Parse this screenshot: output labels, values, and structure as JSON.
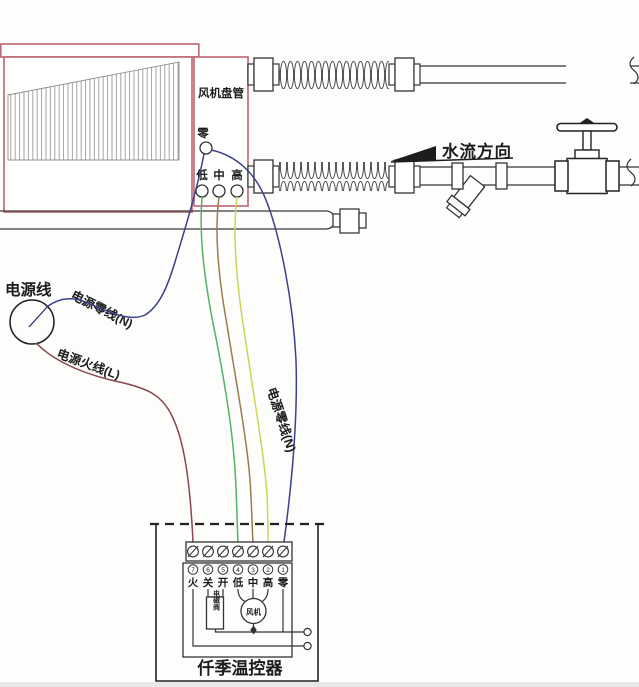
{
  "fan_coil": {
    "label": "风机盘管",
    "neutral": "零",
    "speeds": [
      "低",
      "中",
      "高"
    ]
  },
  "flow": {
    "label": "水流方向"
  },
  "power": {
    "label": "电源线",
    "neutral_n1": "电源零线(N)",
    "live_l": "电源火线(L)",
    "neutral_n2": "电源零线(N)"
  },
  "thermostat": {
    "name": "仟季温控器",
    "solenoid": "电磁阀",
    "fan": "风机",
    "terminals": [
      {
        "num": "7",
        "label": "火"
      },
      {
        "num": "6",
        "label": "关"
      },
      {
        "num": "5",
        "label": "开"
      },
      {
        "num": "4",
        "label": "低"
      },
      {
        "num": "3",
        "label": "中"
      },
      {
        "num": "2",
        "label": "高"
      },
      {
        "num": "1",
        "label": "零"
      }
    ]
  },
  "colors": {
    "unit_outline": "#bf6e79",
    "line": "#2b2b2b",
    "wire_live": "#8d4550",
    "wire_neutral": "#3a3f8f",
    "wire_low": "#52b367",
    "wire_mid": "#9b7a4e",
    "wire_high": "#cfd456"
  }
}
